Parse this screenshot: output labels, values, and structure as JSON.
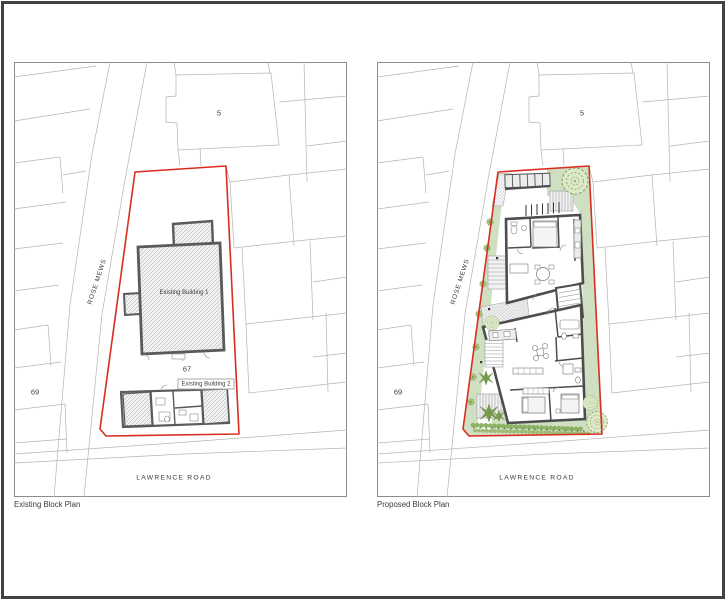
{
  "document": {
    "type": "architectural block plan comparison sheet",
    "sheet_border_color": "#424242"
  },
  "colors": {
    "site_boundary_red": "#d92d20",
    "existing_wall_grey": "#5a5a5a",
    "proposed_wall_grey": "#4d4d4d",
    "landscape_green": "#cfe0c2",
    "planting_green": "#7da24f",
    "parcel_line_grey": "#b4b4b4"
  },
  "panels": {
    "existing": {
      "caption": "Existing Block Plan",
      "labels": {
        "parcel_5": "5",
        "parcel_69": "69",
        "parcel_67": "67",
        "building_1": "Existing Building 1",
        "building_2": "Existing Building 2",
        "rose_mews": "ROSE MEWS",
        "lawrence_road": "LAWRENCE ROAD"
      }
    },
    "proposed": {
      "caption": "Proposed Block Plan",
      "labels": {
        "parcel_5": "5",
        "parcel_69": "69",
        "rose_mews": "ROSE MEWS",
        "lawrence_road": "LAWRENCE ROAD"
      }
    }
  }
}
